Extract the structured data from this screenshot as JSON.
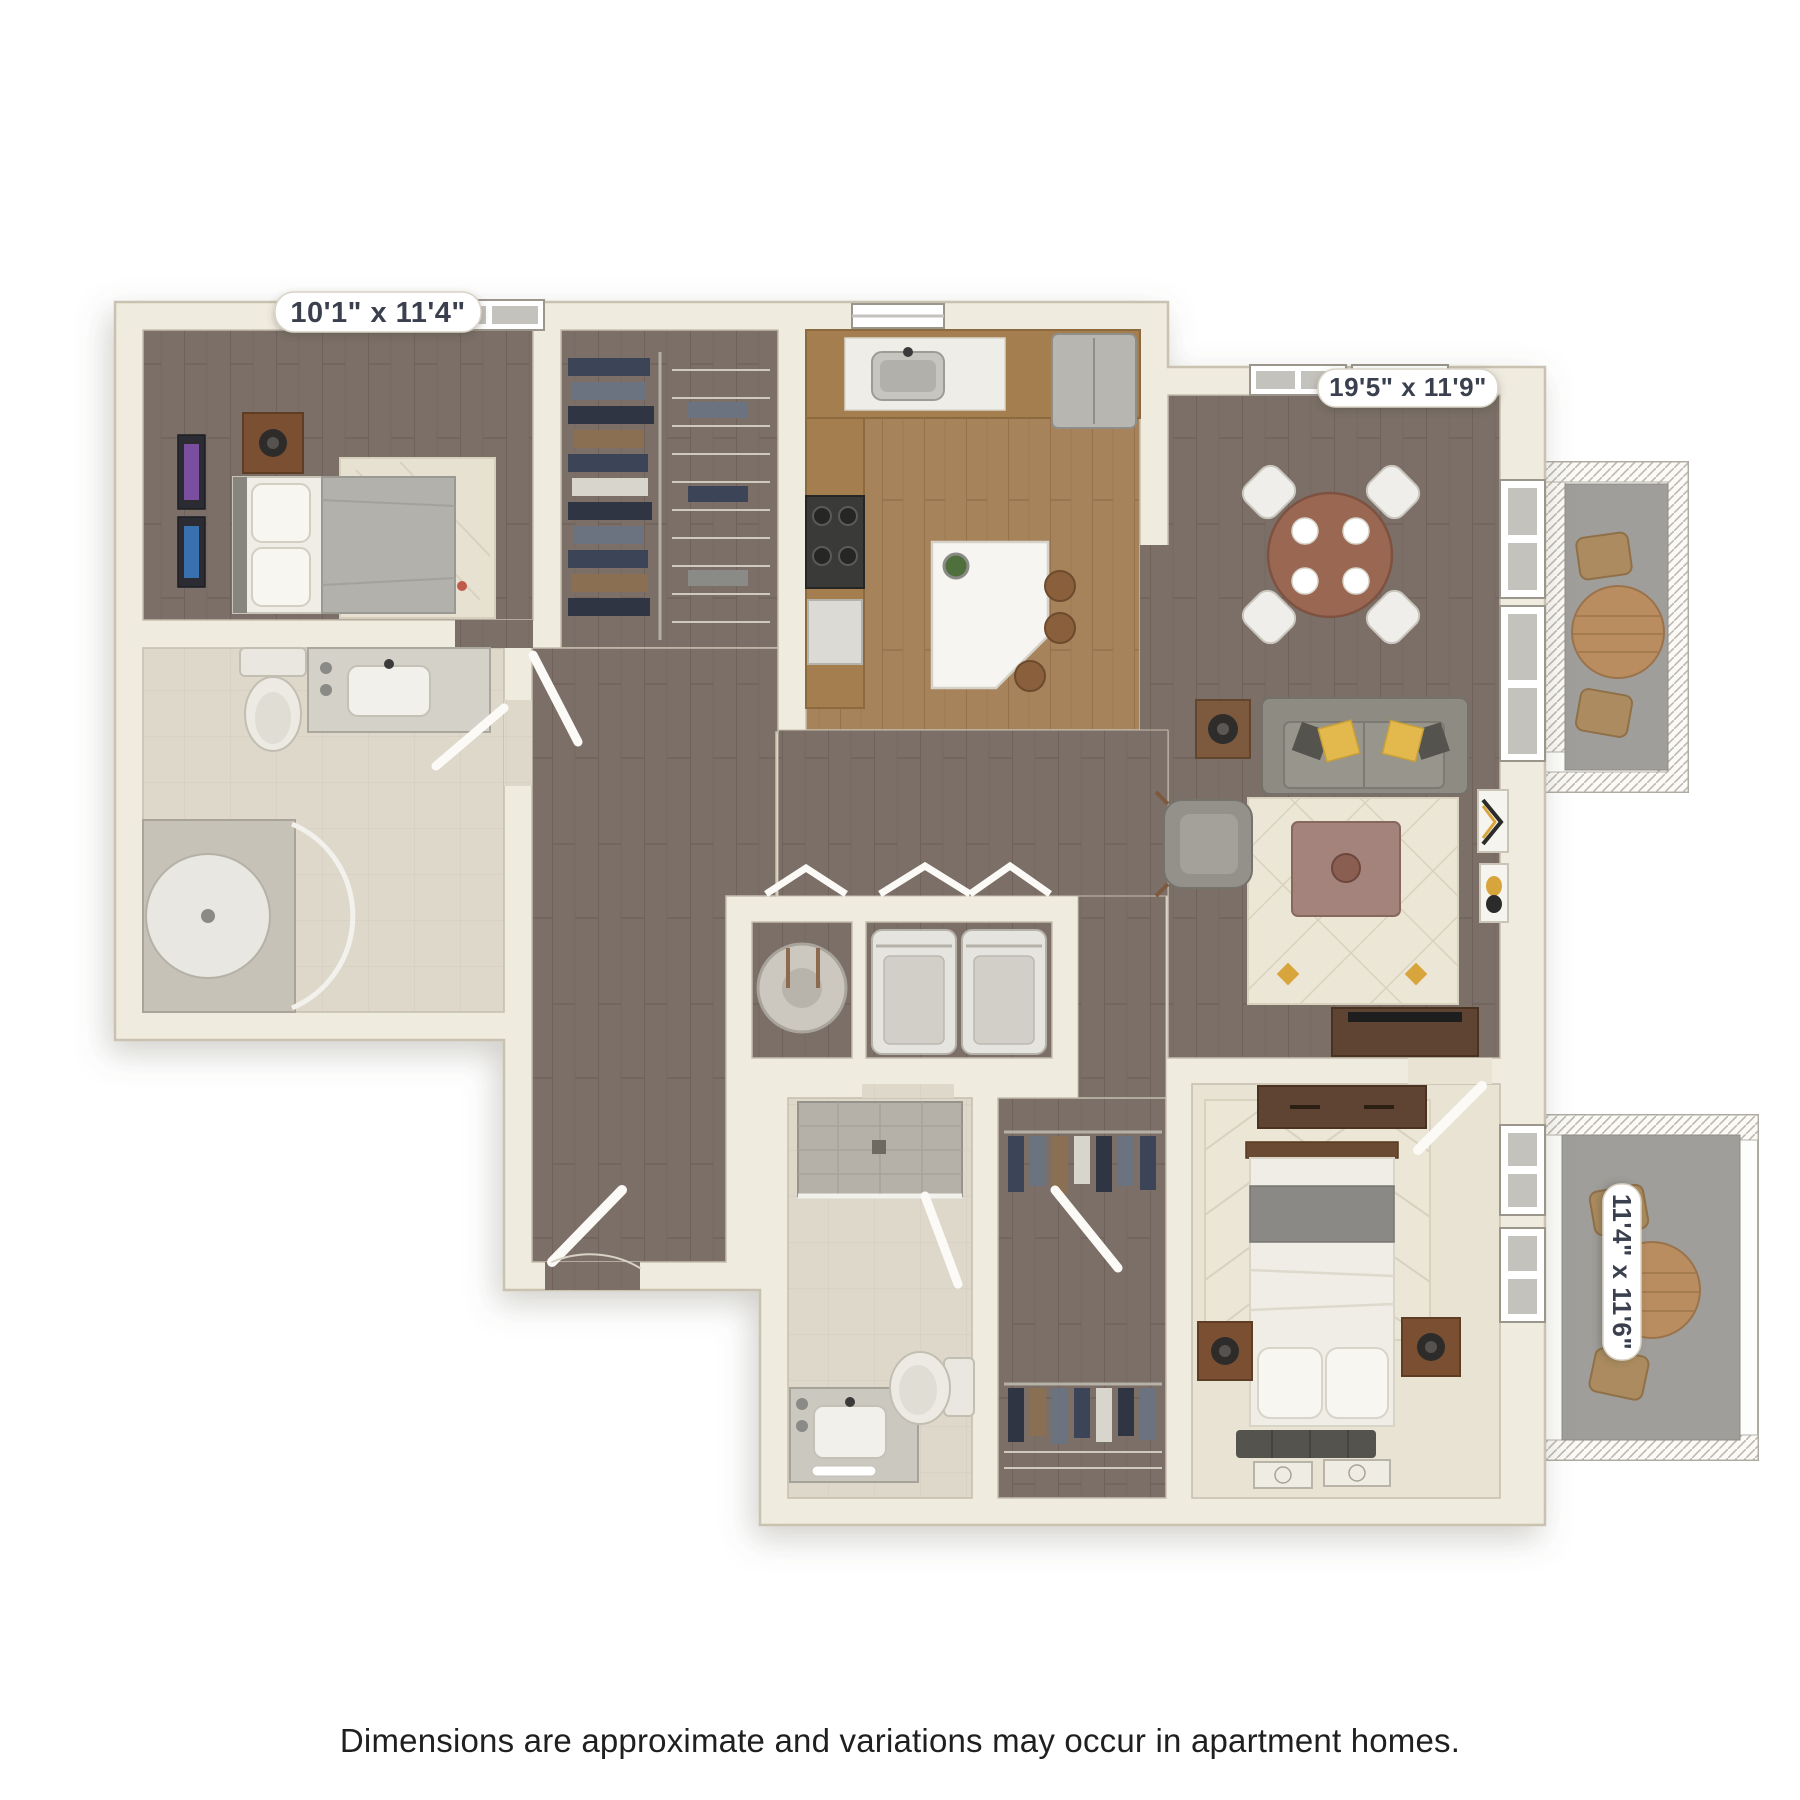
{
  "image": {
    "background": "#ffffff",
    "description_colors": {
      "wall": "#f0ebdf",
      "floor_wood_dark": "#7b6f67",
      "floor_wood_light": "#a6835b",
      "floor_tile": "#ded8ca",
      "floor_carpet": "#e9e3d4",
      "sofa": "#8d8b82",
      "accent_yellow": "#e3b94d",
      "label_text": "#3a4050"
    }
  },
  "floorplan": {
    "dimension_labels": {
      "bedroom1": "10'1\" x 11'4\"",
      "living_room": "19'5\" x 11'9\"",
      "bedroom2": "11'4\" x 11'6\""
    }
  },
  "footer": {
    "disclaimer": "Dimensions are approximate and variations may occur in apartment homes."
  }
}
